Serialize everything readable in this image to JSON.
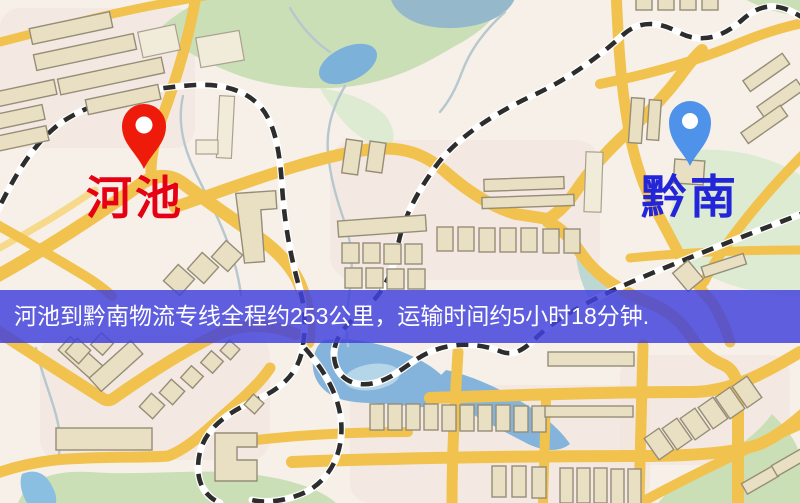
{
  "map": {
    "origin": {
      "name": "河池",
      "pin": "red-map-pin"
    },
    "destination": {
      "name": "黔南",
      "pin": "blue-map-pin"
    },
    "banner": {
      "text": "河池到黔南物流专线全程约253公里，运输时间约5小时18分钟."
    },
    "route": {
      "distance_km": "253",
      "duration": "5小时18分钟"
    }
  },
  "colors": {
    "bg": "#f6f0e8",
    "road": "#f1c24d",
    "road-pale": "#f7d98c",
    "rail": "#2d2d2d",
    "building": "#e9e0c3",
    "building-stroke": "#958d77",
    "building-pale": "#f1ebda",
    "building-pale-stroke": "#a9a190",
    "park": "#cbdfb7",
    "park-soft": "#dcebd2",
    "water": "#84b4dc",
    "water-teal": "#95b9ca",
    "stream": "#b7c7ce",
    "pin-red": "#ee1a0a",
    "pin-blue": "#4e92ea",
    "origin-label": "#e60014",
    "dest-label": "#2326d8",
    "banner-bg": "rgba(66,66,221,0.84)",
    "banner-text": "#ffffff"
  }
}
